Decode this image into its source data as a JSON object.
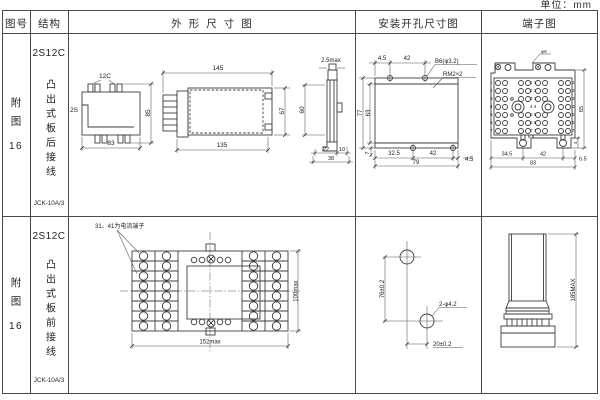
{
  "unit_label": "单位：mm",
  "header": {
    "figure": "图号",
    "structure": "结构",
    "outline": "外形尺寸图",
    "mounting": "安装开孔尺寸图",
    "terminal": "端子图"
  },
  "rows": [
    {
      "figure_cn": "附图",
      "figure_num": "16",
      "model": "2S12C",
      "desc": "凸出式板后接线",
      "code": "JCK-10A/3",
      "outline": {
        "label_12c": "12C",
        "label_2s": "2S",
        "dim_85": "85",
        "dim_83": "83",
        "dim_145": "145",
        "dim_135": "135",
        "dim_67": "67",
        "dim_25": "2.5max",
        "dim_60": "60",
        "dim_22": "22",
        "dim_10": "10",
        "dim_38": "38"
      },
      "mounting": {
        "dim_top_45": "4.5",
        "dim_top_42": "42",
        "note_hole": "B6(φ3.2)",
        "note_thread": "RM2×2",
        "dim_77": "77",
        "dim_63": "63",
        "dim_7": "7",
        "dim_325": "32.5",
        "dim_bot_42": "42",
        "dim_bot_45": "4.5",
        "dim_79": "79"
      },
      "terminal": {
        "note": "φ6",
        "dim_85": "85",
        "dim_4": "4",
        "dim_345": "34.5",
        "dim_42": "42",
        "dim_65": "6.5",
        "dim_83": "83",
        "nums_left": "1\n2\n3\n4\n5\n6\n7",
        "nums_center": "1 1\n2 2\n3 3\n4 4\n5 5\n6 6\n7 7",
        "nums_right": "1\n2\n3\n4\n5\n6\n7",
        "nums_bottom": "8 8"
      }
    },
    {
      "figure_cn": "附图",
      "figure_num": "16",
      "model": "2S12C",
      "desc": "凸出式板前接线",
      "code": "JCK-10A/3",
      "outline": {
        "note": "31、41为电流端子",
        "dim_width": "152max",
        "dim_height": "100max"
      },
      "mounting": {
        "dim_v": "76±0.2",
        "dim_h": "20±0.2",
        "note_hole": "2-φ4.2"
      },
      "terminal": {
        "dim_height": "185MAX"
      }
    }
  ]
}
